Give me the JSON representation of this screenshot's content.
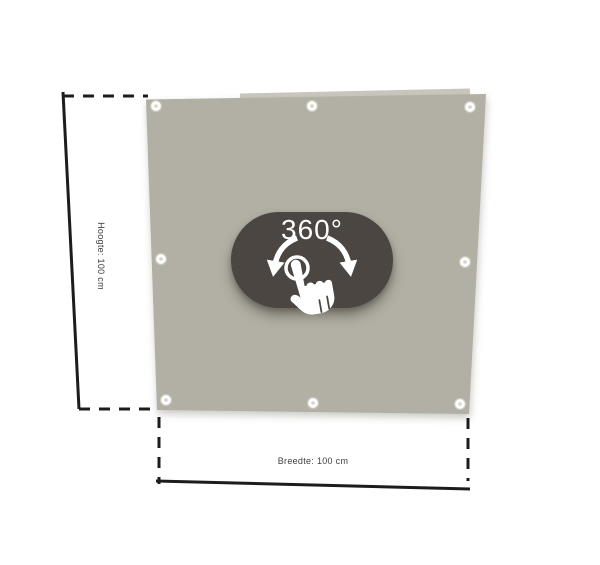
{
  "viewer": {
    "rotate_badge": {
      "label": "360°",
      "background_color": "#4b4641",
      "text_color": "#ffffff",
      "icons": [
        "rotate-left-arrow-icon",
        "rotate-right-arrow-icon",
        "touch-ring-icon",
        "hand-pointer-icon"
      ]
    },
    "product": {
      "type": "banner-panel",
      "panel_color": "#b2b0a5",
      "panel_edge_highlight": "#c9c7bd",
      "grommet_count": 8,
      "grommet_color": "#fdfdfb"
    },
    "dimensions": {
      "height_label": "Hoogte: 100 cm",
      "width_label": "Breedte: 100 cm",
      "height_value": "100 cm",
      "width_value": "100 cm"
    },
    "colors": {
      "dimension_line": "#1c1c1c",
      "label_text": "#3f3f3f",
      "background": "#ffffff"
    }
  }
}
